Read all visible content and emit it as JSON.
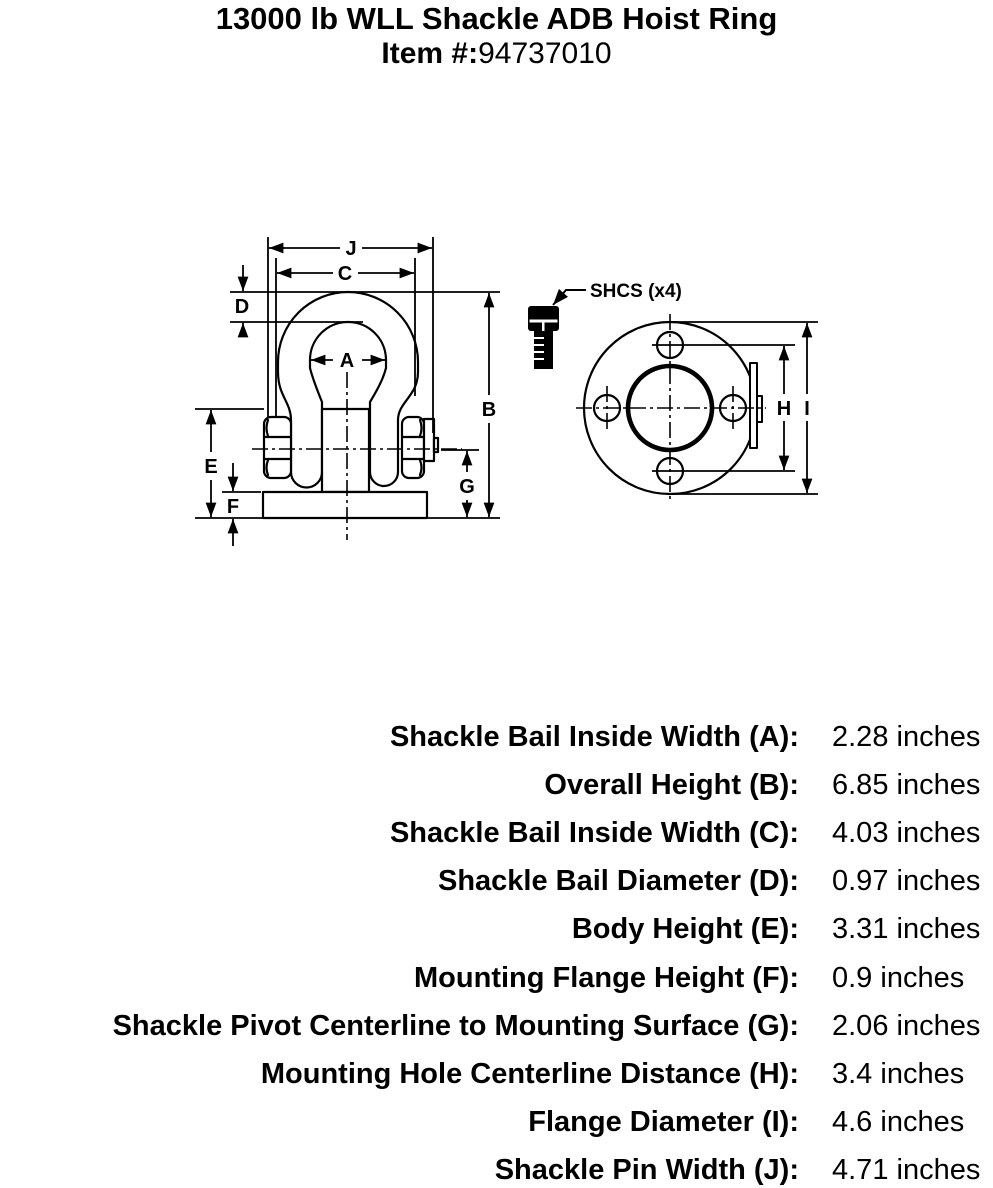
{
  "header": {
    "title": "13000 lb WLL Shackle ADB Hoist Ring",
    "item_label": "Item #:",
    "item_number": "94737010"
  },
  "diagram": {
    "line_color": "#000000",
    "callout": "SHCS (x4)",
    "labels": {
      "a": "A",
      "b": "B",
      "c": "C",
      "d": "D",
      "e": "E",
      "f": "F",
      "g": "G",
      "h": "H",
      "i": "I",
      "j": "J"
    }
  },
  "specs": {
    "rows": [
      {
        "label": "Shackle Bail Inside Width (A):",
        "value": "2.28 inches"
      },
      {
        "label": "Overall Height (B):",
        "value": "6.85 inches"
      },
      {
        "label": "Shackle Bail Inside Width (C):",
        "value": "4.03 inches"
      },
      {
        "label": "Shackle Bail Diameter (D):",
        "value": "0.97 inches"
      },
      {
        "label": "Body Height (E):",
        "value": "3.31 inches"
      },
      {
        "label": "Mounting Flange Height (F):",
        "value": "0.9 inches"
      },
      {
        "label": "Shackle Pivot Centerline to Mounting Surface (G):",
        "value": "2.06 inches"
      },
      {
        "label": "Mounting Hole Centerline Distance (H):",
        "value": "3.4 inches"
      },
      {
        "label": "Flange Diameter (I):",
        "value": "4.6 inches"
      },
      {
        "label": "Shackle Pin Width (J):",
        "value": "4.71 inches"
      }
    ]
  }
}
